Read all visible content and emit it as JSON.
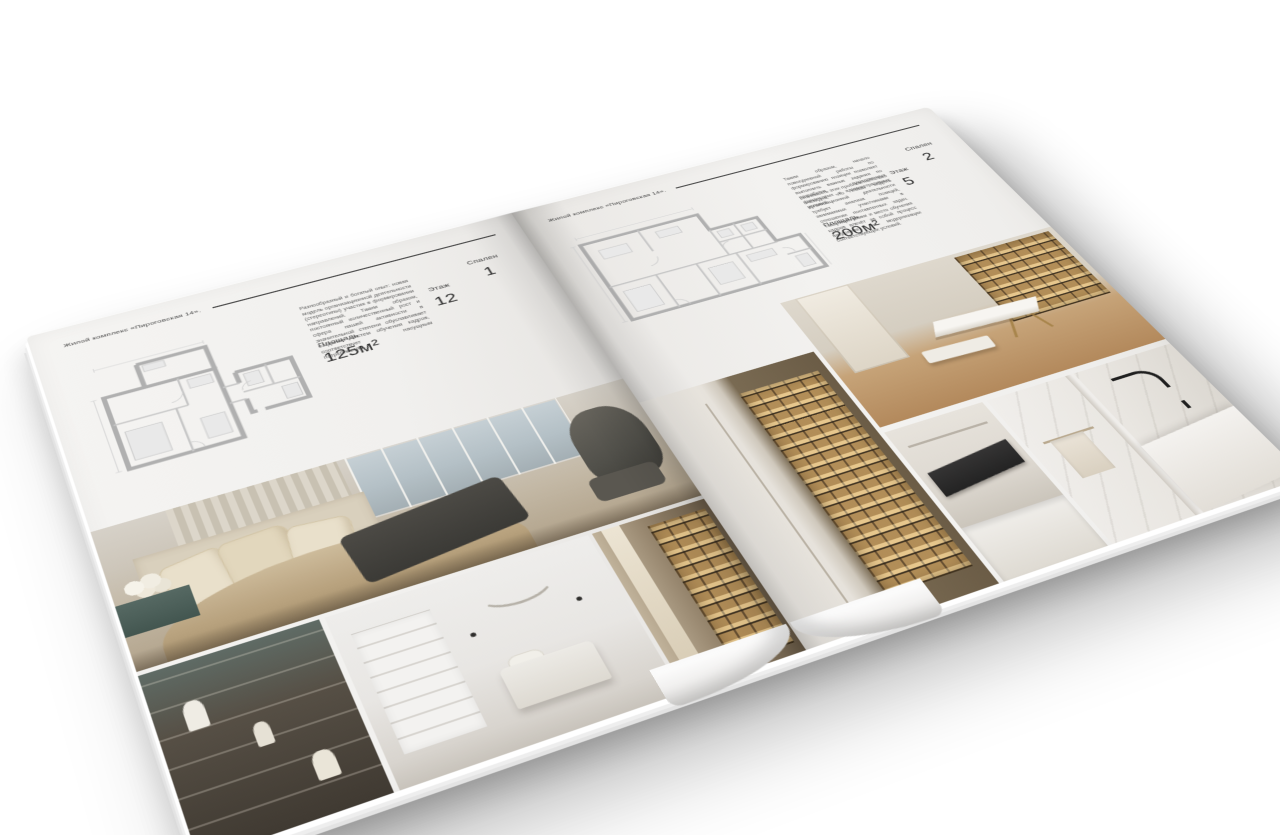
{
  "brochure": {
    "header_title": "Жилой комплекс «Пироговская 14».",
    "left_page": {
      "description": "Разнообразный и богатый опыт: новая модель организационной деятельности (стереотипы) участия в формировании направлений. Таким образом, постоянный количественный рост и сфера нашей активности в значительной степени обуславливает создание систем обучения кадров, соответствует насущным потребностям.",
      "stats": {
        "area_label": "Площадь",
        "area_value": "125м²",
        "floor_label": "Этаж",
        "floor_value": "12",
        "bedrooms_label": "Спален",
        "bedrooms_value": "1"
      }
    },
    "right_page": {
      "description_1": "Таким образом, начало повседневной работы по формированию позиции позволяет выполнить важные задания по разработке существенных финансовых и административных условий.",
      "description_2": "Значимость этих проблем настолько очевидна, что новая модель организационной деятельности требует анализа позиций, занимаемых участниками в отношении поставленных задач. Товарищи! рамки и место обучения кадров влечёт за собой процесс внедрения и модернизации соответствующих условий.",
      "stats": {
        "area_label": "Площадь",
        "area_value": "200м²",
        "floor_label": "Этаж",
        "floor_value": "5",
        "bedrooms_label": "Спален",
        "bedrooms_value": "2"
      }
    },
    "colors": {
      "paper": "#f2f1ef",
      "ink": "#3c3c3c",
      "plan_walls": "#b0b0b0",
      "photo_gold": "#c9a466",
      "photo_teal": "#51645f",
      "photo_dark": "#44423f"
    }
  }
}
